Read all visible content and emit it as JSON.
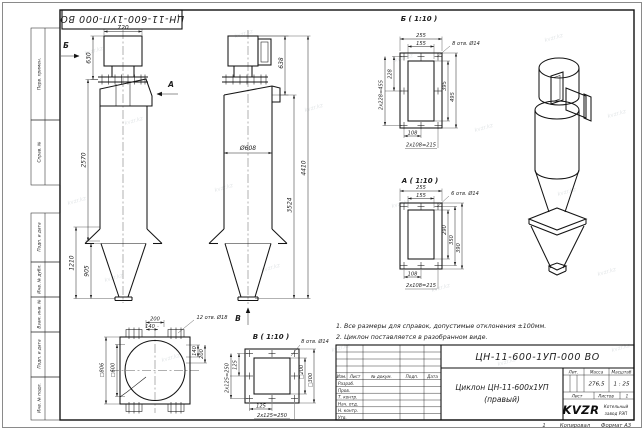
{
  "watermark": "kvzr.kz",
  "frame": {
    "top_designation": "ЦН-11-600-1УП-000 ВО",
    "stamp_columns": [
      "Перв. примен.",
      "Справ. №",
      "Подп. и дата",
      "Инв. № дубл.",
      "Взам. инв. №",
      "Подп. и дата",
      "Инв. № подл."
    ],
    "bottom": {
      "fold_mark": "1",
      "copied_label": "Копировал",
      "format_label": "Формат А3"
    }
  },
  "views": {
    "front": {
      "arrow_b": "Б",
      "arrow_a": "А",
      "dim_720": "720",
      "dim_630": "630",
      "dim_2570": "2570",
      "dim_1210": "1210",
      "dim_905": "905"
    },
    "side": {
      "arrow_v": "В",
      "dim_638": "638",
      "dim_d608": "Ø608",
      "dim_3524": "3524",
      "dim_4410": "4410"
    },
    "section_b": {
      "title": "Б ( 1:10 )",
      "holes": "8 отв. Ø14",
      "dim_255": "255",
      "dim_155": "155",
      "dim_228": "228",
      "dim_455": "2x228=455",
      "dim_395": "395",
      "dim_495": "495",
      "dim_108": "108",
      "dim_215": "2x108=215"
    },
    "section_a": {
      "title": "А ( 1:10 )",
      "holes": "6 отв. Ø14",
      "dim_255": "255",
      "dim_155": "155",
      "dim_290": "290",
      "dim_350": "350",
      "dim_390": "390",
      "dim_108": "108",
      "dim_215": "2x108=215"
    },
    "view_v": {
      "title": "В ( 1:10 )",
      "holes": "8 отв. Ø14",
      "dim_125_l": "125",
      "dim_250_l": "2x125=250",
      "dim_200": "□200",
      "dim_300": "□300",
      "dim_125_b": "125",
      "dim_250_b": "2x125=250"
    },
    "plan": {
      "holes": "12 отв. Ø18",
      "dim_200_t": "200",
      "dim_140_t": "140",
      "dim_806": "□806",
      "dim_600": "□600",
      "dim_140_r": "140",
      "dim_200_r": "200"
    }
  },
  "notes": [
    "1. Все размеры для справок, допустимые отклонения ±100мм.",
    "2. Циклон поставляется в разобранном виде."
  ],
  "title_block": {
    "designation": "ЦН-11-600-1УП-000 ВО",
    "name_line1": "Циклон ЦН-11-600х1УП",
    "name_line2": "(правый)",
    "col_izm": "Изм.",
    "col_list": "Лист",
    "col_doc": "№ докум.",
    "col_sign": "Подп.",
    "col_date": "Дата",
    "rows": [
      "Разраб.",
      "Пров.",
      "Т. контр.",
      "Нач. отд.",
      "Н. контр.",
      "Утв."
    ],
    "lit_label": "Лит.",
    "mass_label": "Масса",
    "scale_label": "Масштаб",
    "mass": "276,5",
    "scale": "1 : 25",
    "sheet_label": "Лист",
    "sheets_label": "Листов",
    "sheets": "1",
    "logo": "KVZR",
    "company_line1": "Котельный",
    "company_line2": "завод РЭП"
  }
}
